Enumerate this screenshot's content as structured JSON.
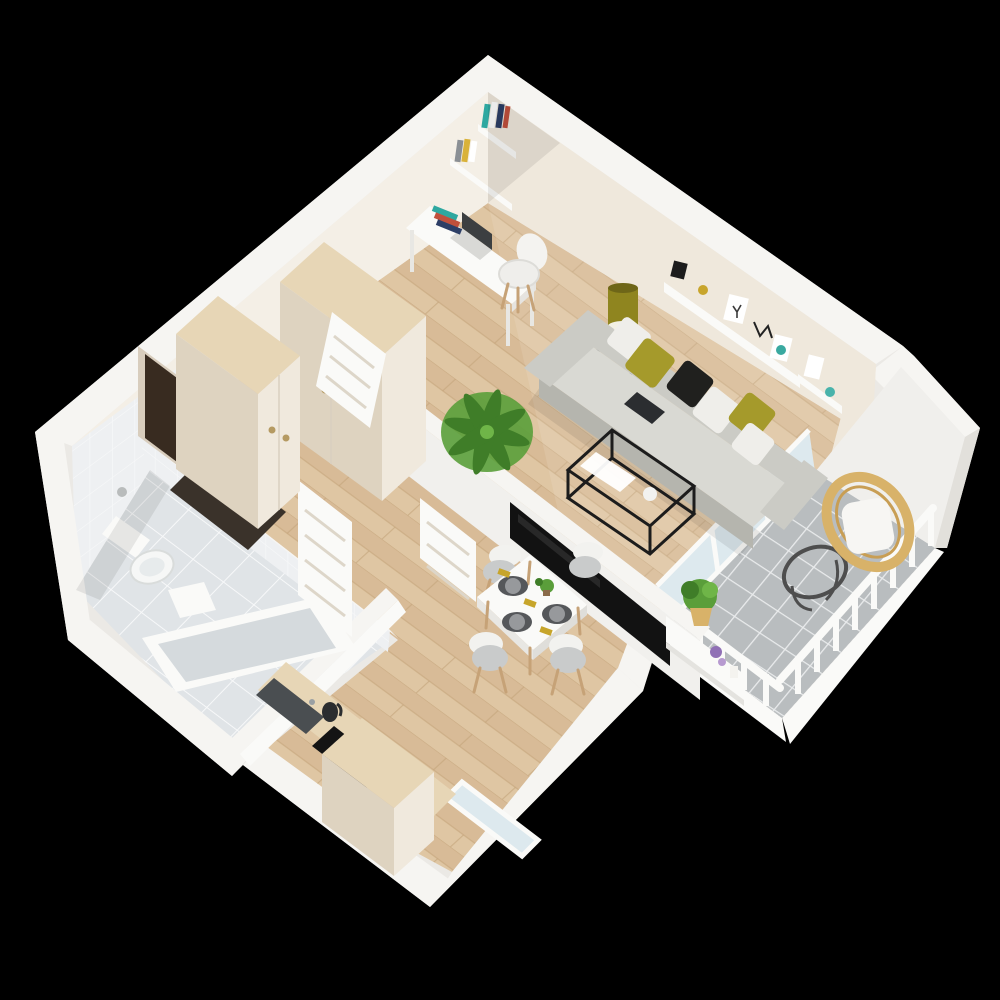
{
  "scene": {
    "type": "isometric-3d-floor-plan-render",
    "background_color": "#000000",
    "rooms": [
      {
        "name": "hallway",
        "items": [
          "entry-door",
          "door-mat",
          "wardrobe-small",
          "wardrobe-large",
          "leaning-white-door"
        ]
      },
      {
        "name": "bathroom",
        "items": [
          "tiled-walls",
          "tiled-floor",
          "toilet",
          "toilet-paper-holder",
          "bathtub",
          "sink",
          "bathroom-door"
        ]
      },
      {
        "name": "kitchen",
        "items": [
          "counter",
          "sink-basin",
          "kettle",
          "cooktop",
          "wood-cabinet",
          "window"
        ]
      },
      {
        "name": "dining-area",
        "items": [
          "dining-table",
          "dining-chair",
          "dining-chair",
          "dining-chair",
          "dining-chair",
          "place-setting",
          "place-setting",
          "place-setting",
          "centerpiece-plant"
        ]
      },
      {
        "name": "living-room",
        "items": [
          "sofa",
          "pillow-white",
          "pillow-olive",
          "pillow-black",
          "pillow-white",
          "pillow-olive",
          "tablet",
          "coffee-table",
          "magazine",
          "vase",
          "side-table",
          "table-lamp",
          "wall-shelf",
          "picture-frames",
          "deer-art",
          "tv",
          "tv-partition-wall",
          "palm-plant",
          "desk",
          "desk-chair",
          "laptop",
          "book-stack",
          "wall-book-shelves",
          "open-door"
        ]
      },
      {
        "name": "balcony",
        "items": [
          "tile-floor",
          "privacy-wall",
          "railing",
          "glass-doors",
          "rattan-chair",
          "seat-cushion",
          "round-side-table",
          "plant-shelf",
          "potted-plant",
          "flowers",
          "candle"
        ]
      }
    ]
  },
  "palette": {
    "bg": "#000000",
    "silhouette": "#ebe9e5",
    "wallTop": "#f6f5f2",
    "wallFaceNE": "#efe8dc",
    "wallFaceNW": "#f4efe6",
    "wallSide": "#e2e0db",
    "wood": "#d8bb97",
    "woodLight": "#e7d2b1",
    "woodSeam": "#c2a178",
    "cabinetFront": "#f0e9dd",
    "cabinetSide": "#ded3c0",
    "cabinetTop": "#e7d6b6",
    "darkDoor": "#382b20",
    "doorMat": "#3a322a",
    "white": "#fafaf8",
    "sofaBody": "#cbcbc5",
    "sofaSeat": "#d9d9d3",
    "sofaShade": "#b5b5ae",
    "pillowWhite": "#efeeea",
    "pillowOlive": "#a59a2b",
    "pillowBlack": "#20201e",
    "tvBlack": "#121212",
    "frameBlack": "#1c1c1c",
    "glass": "#dde9ee",
    "tileFloor": "#b9bdbf",
    "tileGrout": "#e9ebec",
    "bathFloor": "#e0e4e7",
    "bathWall": "#eef0f2",
    "bathGrout": "#f7f8f9",
    "rattan": "#d8b269",
    "metal": "#4e4e4e",
    "green": "#5a9e3a",
    "greenDark": "#3f7d28",
    "plate": "#97999c",
    "placemat": "#55575a",
    "napkin": "#c7a52b",
    "purple": "#9070b5",
    "woodLeg": "#c6a277",
    "lampOlive": "#8f851f"
  }
}
